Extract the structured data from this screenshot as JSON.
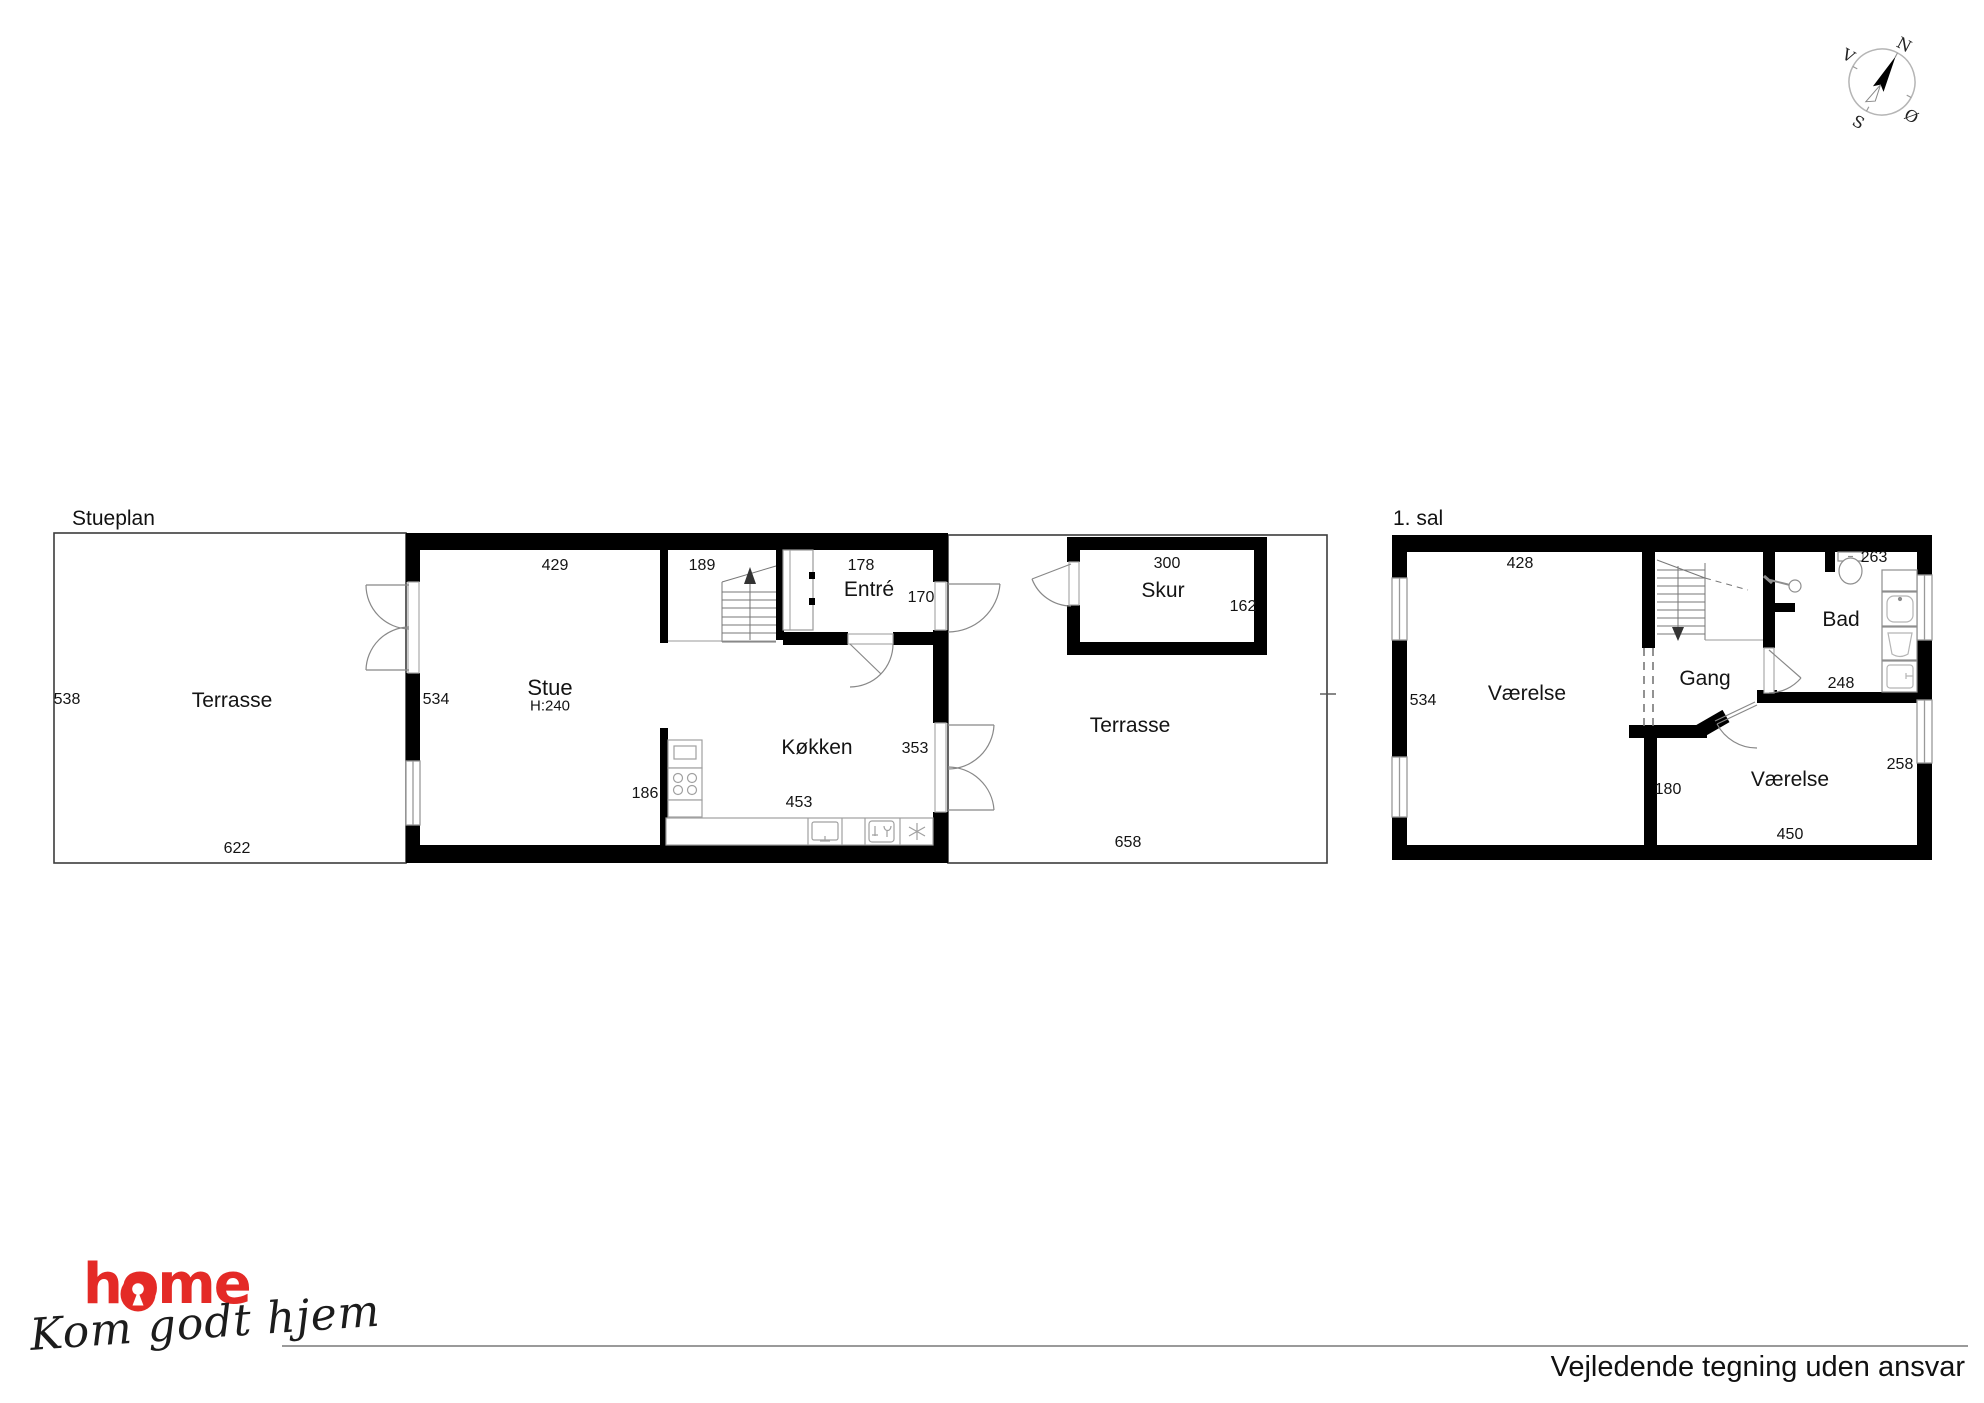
{
  "titles": {
    "ground": "Stueplan",
    "first": "1. sal"
  },
  "footer": {
    "disclaimer": "Vejledende tegning uden ansvar"
  },
  "brand": {
    "name": "home",
    "tagline": "Kom godt hjem",
    "color": "#e42a26"
  },
  "compass": {
    "n": "N",
    "s": "S",
    "e": "Ø",
    "w": "V"
  },
  "ground_floor": {
    "terrace_left": {
      "name": "Terrasse",
      "dim_left": "538",
      "dim_bottom": "622"
    },
    "stue": {
      "name": "Stue",
      "ceiling_height": "H:240",
      "dim_top": "429",
      "dim_left": "534"
    },
    "stairs": {
      "dim_top": "189"
    },
    "entre": {
      "name": "Entré",
      "dim_top": "178",
      "dim_right": "170"
    },
    "kitchen": {
      "name": "Køkken",
      "dim_bottom": "453",
      "dim_right": "353",
      "dim_left": "186"
    },
    "skur": {
      "name": "Skur",
      "dim_top": "300",
      "dim_right": "162"
    },
    "terrace_right": {
      "name": "Terrasse",
      "dim_bottom": "658"
    }
  },
  "first_floor": {
    "room_left": {
      "name": "Værelse",
      "dim_top": "428",
      "dim_left": "534"
    },
    "gang": {
      "name": "Gang"
    },
    "bad": {
      "name": "Bad",
      "dim_top": "263",
      "dim_bottom": "248"
    },
    "room_right": {
      "name": "Værelse",
      "dim_bottom": "450",
      "dim_left": "180",
      "dim_right": "258"
    }
  }
}
